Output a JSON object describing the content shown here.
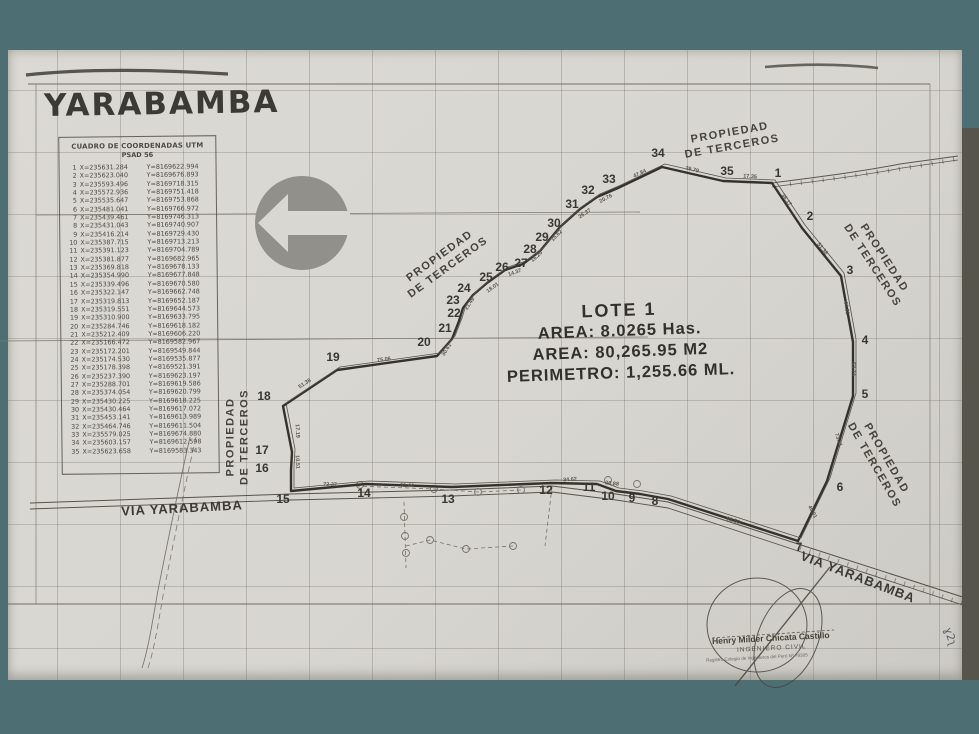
{
  "title": "YARABAMBA",
  "coordinate_table": {
    "header": "CUADRO DE COORDENADAS UTM",
    "datum": "PSAD 56",
    "rows": [
      {
        "n": "1",
        "x": "X=235631.284",
        "y": "Y=8169622.994"
      },
      {
        "n": "2",
        "x": "X=235623.040",
        "y": "Y=8169676.893"
      },
      {
        "n": "3",
        "x": "X=235593.496",
        "y": "Y=8169718.315"
      },
      {
        "n": "4",
        "x": "X=235572.936",
        "y": "Y=8169751.418"
      },
      {
        "n": "5",
        "x": "X=235535.647",
        "y": "Y=8169753.868"
      },
      {
        "n": "6",
        "x": "X=235481.041",
        "y": "Y=8169766.972"
      },
      {
        "n": "7",
        "x": "X=235439.461",
        "y": "Y=8169746.313"
      },
      {
        "n": "8",
        "x": "X=235431.043",
        "y": "Y=8169740.907"
      },
      {
        "n": "9",
        "x": "X=235416.214",
        "y": "Y=8169729.430"
      },
      {
        "n": "10",
        "x": "X=235387.715",
        "y": "Y=8169713.213"
      },
      {
        "n": "11",
        "x": "X=235391.123",
        "y": "Y=8169704.789"
      },
      {
        "n": "12",
        "x": "X=235381.877",
        "y": "Y=8169682.965"
      },
      {
        "n": "13",
        "x": "X=235369.818",
        "y": "Y=8169678.133"
      },
      {
        "n": "14",
        "x": "X=235354.990",
        "y": "Y=8169677.848"
      },
      {
        "n": "15",
        "x": "X=235339.496",
        "y": "Y=8169670.580"
      },
      {
        "n": "16",
        "x": "X=235322.147",
        "y": "Y=8169662.748"
      },
      {
        "n": "17",
        "x": "X=235319.813",
        "y": "Y=8169652.187"
      },
      {
        "n": "18",
        "x": "X=235319.551",
        "y": "Y=8169644.573"
      },
      {
        "n": "19",
        "x": "X=235310.900",
        "y": "Y=8169633.795"
      },
      {
        "n": "20",
        "x": "X=235284.746",
        "y": "Y=8169618.182"
      },
      {
        "n": "21",
        "x": "X=235212.409",
        "y": "Y=8169606.220"
      },
      {
        "n": "22",
        "x": "X=235166.472",
        "y": "Y=8169582.967"
      },
      {
        "n": "23",
        "x": "X=235172.201",
        "y": "Y=8169549.844"
      },
      {
        "n": "24",
        "x": "X=235174.530",
        "y": "Y=8169535.877"
      },
      {
        "n": "25",
        "x": "X=235178.398",
        "y": "Y=8169521.391"
      },
      {
        "n": "26",
        "x": "X=235237.390",
        "y": "Y=8169623.197"
      },
      {
        "n": "27",
        "x": "X=235288.701",
        "y": "Y=8169619.586"
      },
      {
        "n": "28",
        "x": "X=235374.054",
        "y": "Y=8169620.799"
      },
      {
        "n": "29",
        "x": "X=235430.225",
        "y": "Y=8169618.225"
      },
      {
        "n": "30",
        "x": "X=235430.464",
        "y": "Y=8169617.072"
      },
      {
        "n": "31",
        "x": "X=235453.141",
        "y": "Y=8169613.989"
      },
      {
        "n": "32",
        "x": "X=235464.746",
        "y": "Y=8169611.504"
      },
      {
        "n": "33",
        "x": "X=235579.025",
        "y": "Y=8169674.880"
      },
      {
        "n": "34",
        "x": "X=235603.157",
        "y": "Y=8169612.598"
      },
      {
        "n": "35",
        "x": "X=235623.658",
        "y": "Y=8169583.343"
      }
    ]
  },
  "lot_info": {
    "name": "LOTE 1",
    "area_has": "AREA: 8.0265 Has.",
    "area_m2": "AREA: 80,265.95 M2",
    "perimeter": "PERIMETRO: 1,255.66 ML."
  },
  "stamp": {
    "name": "Henry Milder Chicata Castillo",
    "role": "INGENIERO CIVIL",
    "registry": "Registro Colegio de Ingenieros del Perú Nº 79305",
    "hand_note": "ɣ2ʅ"
  },
  "map": {
    "text_labels": [
      {
        "cls": "prop",
        "x": 731,
        "y": 140,
        "r": -10,
        "lines": [
          "PROPIEDAD",
          "DE TERCEROS"
        ]
      },
      {
        "cls": "prop",
        "x": 444,
        "y": 262,
        "r": -36,
        "lines": [
          "PROPIEDAD",
          "DE TERCEROS"
        ]
      },
      {
        "cls": "prop",
        "x": 878,
        "y": 262,
        "r": 57,
        "lines": [
          "PROPIEDAD",
          "DE TERCEROS"
        ]
      },
      {
        "cls": "prop",
        "x": 880,
        "y": 462,
        "r": 60,
        "lines": [
          "PROPIEDAD",
          "DE TERCEROS"
        ]
      },
      {
        "cls": "prop",
        "x": 238,
        "y": 437,
        "r": -90,
        "lines": [
          "PROPIEDAD",
          "DE TERCEROS"
        ]
      },
      {
        "cls": "via",
        "x": 182,
        "y": 508,
        "r": -3,
        "lines": [
          "VIA YARABAMBA"
        ]
      },
      {
        "cls": "via",
        "x": 858,
        "y": 577,
        "r": 21,
        "lines": [
          "VIA YARABAMBA"
        ]
      }
    ],
    "vertex_labels": [
      {
        "n": "1",
        "x": 778,
        "y": 173
      },
      {
        "n": "2",
        "x": 810,
        "y": 216
      },
      {
        "n": "3",
        "x": 850,
        "y": 270
      },
      {
        "n": "4",
        "x": 865,
        "y": 340
      },
      {
        "n": "5",
        "x": 865,
        "y": 394
      },
      {
        "n": "6",
        "x": 840,
        "y": 487
      },
      {
        "n": "7",
        "x": 799,
        "y": 547
      },
      {
        "n": "8",
        "x": 655,
        "y": 501
      },
      {
        "n": "9",
        "x": 632,
        "y": 498
      },
      {
        "n": "10",
        "x": 608,
        "y": 496
      },
      {
        "n": "11",
        "x": 589,
        "y": 487
      },
      {
        "n": "12",
        "x": 546,
        "y": 490
      },
      {
        "n": "13",
        "x": 448,
        "y": 499
      },
      {
        "n": "14",
        "x": 364,
        "y": 493
      },
      {
        "n": "15",
        "x": 283,
        "y": 499
      },
      {
        "n": "16",
        "x": 262,
        "y": 468
      },
      {
        "n": "17",
        "x": 262,
        "y": 450
      },
      {
        "n": "18",
        "x": 264,
        "y": 396
      },
      {
        "n": "19",
        "x": 333,
        "y": 357
      },
      {
        "n": "20",
        "x": 424,
        "y": 342
      },
      {
        "n": "21",
        "x": 445,
        "y": 328
      },
      {
        "n": "22",
        "x": 454,
        "y": 313
      },
      {
        "n": "23",
        "x": 453,
        "y": 300
      },
      {
        "n": "24",
        "x": 464,
        "y": 288
      },
      {
        "n": "25",
        "x": 486,
        "y": 277
      },
      {
        "n": "26",
        "x": 502,
        "y": 267
      },
      {
        "n": "27",
        "x": 521,
        "y": 263
      },
      {
        "n": "28",
        "x": 530,
        "y": 249
      },
      {
        "n": "29",
        "x": 542,
        "y": 237
      },
      {
        "n": "30",
        "x": 554,
        "y": 223
      },
      {
        "n": "31",
        "x": 572,
        "y": 204
      },
      {
        "n": "32",
        "x": 588,
        "y": 190
      },
      {
        "n": "33",
        "x": 609,
        "y": 179
      },
      {
        "n": "34",
        "x": 658,
        "y": 153
      },
      {
        "n": "35",
        "x": 727,
        "y": 171
      }
    ],
    "edge_labels": [
      {
        "t": "51.38",
        "x": 305,
        "y": 384,
        "r": -33
      },
      {
        "t": "75.06",
        "x": 384,
        "y": 360,
        "r": -7
      },
      {
        "t": "30.61",
        "x": 447,
        "y": 350,
        "r": -58
      },
      {
        "t": "17.19",
        "x": 297,
        "y": 431,
        "r": 87
      },
      {
        "t": "10.51",
        "x": 297,
        "y": 462,
        "r": 87
      },
      {
        "t": "21.49",
        "x": 470,
        "y": 304,
        "r": -56
      },
      {
        "t": "18.01",
        "x": 493,
        "y": 288,
        "r": -36
      },
      {
        "t": "14.37",
        "x": 515,
        "y": 273,
        "r": -20
      },
      {
        "t": "16.20",
        "x": 537,
        "y": 257,
        "r": -42
      },
      {
        "t": "15.62",
        "x": 557,
        "y": 236,
        "r": -45
      },
      {
        "t": "26.37",
        "x": 585,
        "y": 214,
        "r": -34
      },
      {
        "t": "20.76",
        "x": 606,
        "y": 199,
        "r": -28
      },
      {
        "t": "47.84",
        "x": 640,
        "y": 174,
        "r": -26
      },
      {
        "t": "39.79",
        "x": 692,
        "y": 170,
        "r": 13
      },
      {
        "t": "17.35",
        "x": 750,
        "y": 177,
        "r": 4
      },
      {
        "t": "36.17",
        "x": 786,
        "y": 200,
        "r": 54
      },
      {
        "t": "51.38",
        "x": 822,
        "y": 249,
        "r": 51
      },
      {
        "t": "44.81",
        "x": 846,
        "y": 308,
        "r": 80
      },
      {
        "t": "53.74",
        "x": 853,
        "y": 369,
        "r": 88
      },
      {
        "t": "73.31",
        "x": 838,
        "y": 440,
        "r": 72
      },
      {
        "t": "40.91",
        "x": 812,
        "y": 512,
        "r": 62
      },
      {
        "t": "92.50",
        "x": 733,
        "y": 521,
        "r": 17
      },
      {
        "t": "51.44",
        "x": 407,
        "y": 486,
        "r": 2
      },
      {
        "t": "34.62",
        "x": 570,
        "y": 480,
        "r": -4
      },
      {
        "t": "20.88",
        "x": 612,
        "y": 484,
        "r": 6
      },
      {
        "t": "72.37",
        "x": 330,
        "y": 485,
        "r": 2
      }
    ],
    "poles": [
      [
        404,
        517
      ],
      [
        405,
        536
      ],
      [
        406,
        553
      ],
      [
        430,
        540
      ],
      [
        466,
        549
      ],
      [
        513,
        546
      ],
      [
        360,
        485
      ],
      [
        434,
        489
      ],
      [
        478,
        492
      ],
      [
        521,
        490
      ],
      [
        608,
        480
      ],
      [
        637,
        484
      ]
    ]
  },
  "geometry": {
    "lot_polygon": "772,183 802,228 841,276 853,342 853,396 827,481 798,541 668,499 640,494 616,491 597,484 552,483 452,487 366,484 291,491 291,470 292,452 283,406 337,370 437,356 452,339 459,321 463,308 473,295 487,283 505,270 523,264 540,251 550,239 560,227 580,209 597,197 618,188 662,167 723,181",
    "road_top_a": "M772,183 C810,178 860,172 900,164 L958,156",
    "road_top_b": "M772,187 C810,182 862,176 902,168 L958,160",
    "road_bottom_a": "M30,503 L291,494 L452,490 L552,486 L616,494 L668,502 L798,544 L975,601",
    "road_bottom_b": "M30,509 L291,500 L452,496 L552,492 L616,500 L668,508 L795,550 L972,608",
    "road_left_a": "M190,437 C178,490 168,540 158,590 C152,625 148,650 142,668",
    "road_left_b": "M196,437 C184,490 174,540 164,590 C158,625 154,650 148,668",
    "hatch_top": "M790,184 C840,178 900,170 956,159",
    "hatch_bottom": "M800,548 L970,606",
    "smudge_left": "M26,75 C90,68 160,70 228,74",
    "smudge_right": "M765,67 C812,63 852,65 878,68",
    "stamp_slash": "M735,686 L830,567",
    "stamp_dash": "M712,638 L834,630",
    "util_dash1": "M404,502 L406,568",
    "util_dash2": "M406,546 L430,540 L466,549 L513,546",
    "util_dash3": "M356,486 L434,489 L478,492 L521,490",
    "util_dash4": "M552,487 L545,546"
  }
}
